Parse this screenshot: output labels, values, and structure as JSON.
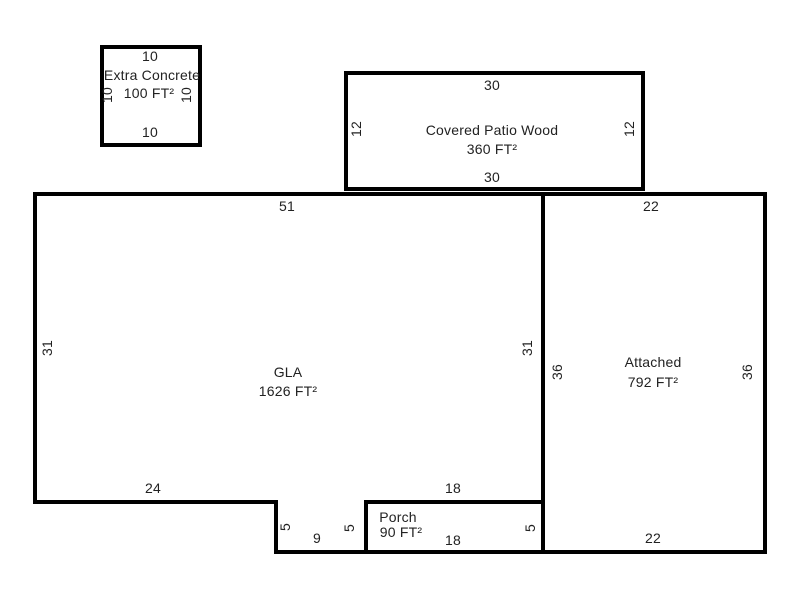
{
  "sketch": {
    "title": "Property floor plan sketch",
    "canvas": {
      "width": 800,
      "height": 600,
      "background": "#ffffff",
      "line_color": "#000000",
      "text_color": "#222222"
    },
    "areas": [
      {
        "id": "covered-patio-wood",
        "label": "Covered Patio Wood",
        "area": "360 FT²",
        "shape": "M346 73 H643 V189 H346 Z"
      },
      {
        "id": "gla",
        "label": "GLA",
        "area": "1626 FT²",
        "shape": "M35 194 H543 V502 H366 V552 H276 V502 H35 Z"
      },
      {
        "id": "attached",
        "label": "Attached",
        "area": "792 FT²",
        "shape": "M543 194 H765 V552 H543 Z"
      },
      {
        "id": "porch",
        "label": "Porch",
        "area": "90 FT²",
        "shape": "M366 502 H543 V552 H366 Z"
      },
      {
        "id": "extra-concrete",
        "label": "Extra Concrete",
        "area": "100 FT²",
        "shape": "M102 47 H200 V145 H102 Z"
      }
    ],
    "labels": [
      {
        "name": "extra-concrete-dim-top",
        "text": "10",
        "x": 150,
        "y": 56,
        "rot": 0
      },
      {
        "name": "extra-concrete-title",
        "text": "Extra Concrete",
        "x": 152,
        "y": 75,
        "rot": 0
      },
      {
        "name": "extra-concrete-area",
        "text": "100 FT²",
        "x": 149,
        "y": 93,
        "rot": 0
      },
      {
        "name": "extra-concrete-dim-left",
        "text": "10",
        "x": 107,
        "y": 95,
        "rot": -90
      },
      {
        "name": "extra-concrete-dim-right",
        "text": "10",
        "x": 186,
        "y": 95,
        "rot": -90
      },
      {
        "name": "extra-concrete-dim-bottom",
        "text": "10",
        "x": 150,
        "y": 132,
        "rot": 0
      },
      {
        "name": "covered-patio-dim-top",
        "text": "30",
        "x": 492,
        "y": 85,
        "rot": 0
      },
      {
        "name": "covered-patio-dim-left",
        "text": "12",
        "x": 356,
        "y": 129,
        "rot": -90
      },
      {
        "name": "covered-patio-title",
        "text": "Covered Patio Wood",
        "x": 492,
        "y": 130,
        "rot": 0
      },
      {
        "name": "covered-patio-dim-right",
        "text": "12",
        "x": 629,
        "y": 129,
        "rot": -90
      },
      {
        "name": "covered-patio-area",
        "text": "360 FT²",
        "x": 492,
        "y": 149,
        "rot": 0
      },
      {
        "name": "covered-patio-dim-bottom",
        "text": "30",
        "x": 492,
        "y": 177,
        "rot": 0
      },
      {
        "name": "gla-dim-top",
        "text": "51",
        "x": 287,
        "y": 206,
        "rot": 0
      },
      {
        "name": "attached-dim-top",
        "text": "22",
        "x": 651,
        "y": 206,
        "rot": 0
      },
      {
        "name": "gla-dim-left",
        "text": "31",
        "x": 47,
        "y": 348,
        "rot": -90
      },
      {
        "name": "gla-dim-right",
        "text": "31",
        "x": 527,
        "y": 348,
        "rot": -90
      },
      {
        "name": "attached-title",
        "text": "Attached",
        "x": 653,
        "y": 362,
        "rot": 0
      },
      {
        "name": "attached-dim-left",
        "text": "36",
        "x": 557,
        "y": 372,
        "rot": -90
      },
      {
        "name": "attached-dim-right",
        "text": "36",
        "x": 747,
        "y": 372,
        "rot": -90
      },
      {
        "name": "gla-title",
        "text": "GLA",
        "x": 288,
        "y": 372,
        "rot": 0
      },
      {
        "name": "attached-area",
        "text": "792 FT²",
        "x": 653,
        "y": 382,
        "rot": 0
      },
      {
        "name": "gla-area",
        "text": "1626 FT²",
        "x": 288,
        "y": 391,
        "rot": 0
      },
      {
        "name": "gla-dim-bottom-left",
        "text": "24",
        "x": 153,
        "y": 488,
        "rot": 0
      },
      {
        "name": "gla-dim-bottom-right",
        "text": "18",
        "x": 453,
        "y": 488,
        "rot": 0
      },
      {
        "name": "porch-title",
        "text": "Porch",
        "x": 398,
        "y": 517,
        "rot": 0
      },
      {
        "name": "gla-dim-notch-left",
        "text": "5",
        "x": 285,
        "y": 527,
        "rot": -90
      },
      {
        "name": "gla-dim-notch-right",
        "text": "5",
        "x": 349,
        "y": 528,
        "rot": -90
      },
      {
        "name": "porch-dim-right",
        "text": "5",
        "x": 530,
        "y": 528,
        "rot": -90
      },
      {
        "name": "porch-area",
        "text": "90 FT²",
        "x": 401,
        "y": 532,
        "rot": 0
      },
      {
        "name": "gla-dim-notch-bottom",
        "text": "9",
        "x": 317,
        "y": 538,
        "rot": 0
      },
      {
        "name": "attached-dim-bottom",
        "text": "22",
        "x": 653,
        "y": 538,
        "rot": 0
      },
      {
        "name": "porch-dim-bottom",
        "text": "18",
        "x": 453,
        "y": 540,
        "rot": 0
      }
    ]
  }
}
